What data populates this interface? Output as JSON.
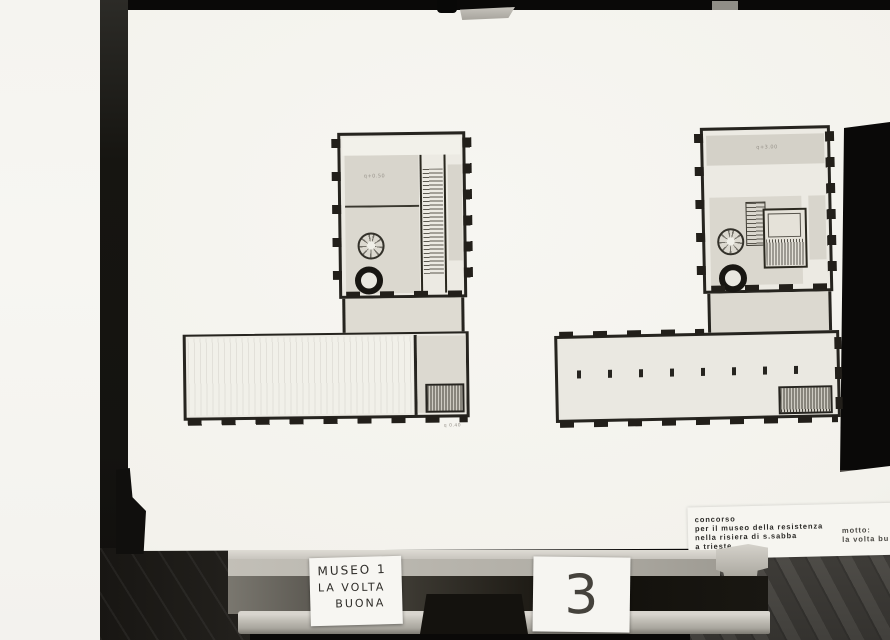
{
  "board": {
    "competition_label": {
      "line1": "concorso",
      "line2": "per il museo della resistenza",
      "line3": "nella risiera di s.sabba",
      "line4": "a trieste",
      "motto_label": "motto:",
      "motto_value": "la volta bu"
    },
    "plans": {
      "left": {
        "level_note": "q+0.50",
        "detail_note": "q 0.40"
      },
      "right": {
        "level_note": "q+3.00"
      }
    }
  },
  "easel": {
    "title_card": {
      "line1": "MUSEO 1",
      "line2": "LA VOLTA",
      "line3": "BUONA"
    },
    "number_card": {
      "value": "3"
    }
  },
  "colors": {
    "backdrop": "#0a0908",
    "board": "#f3f2ec",
    "plan_wall": "#26241f",
    "plan_room_gray": "#d8d5cc",
    "wood_rail": "#c2bfb7",
    "floor": "#5b5852",
    "ink": "#2b2a27"
  }
}
